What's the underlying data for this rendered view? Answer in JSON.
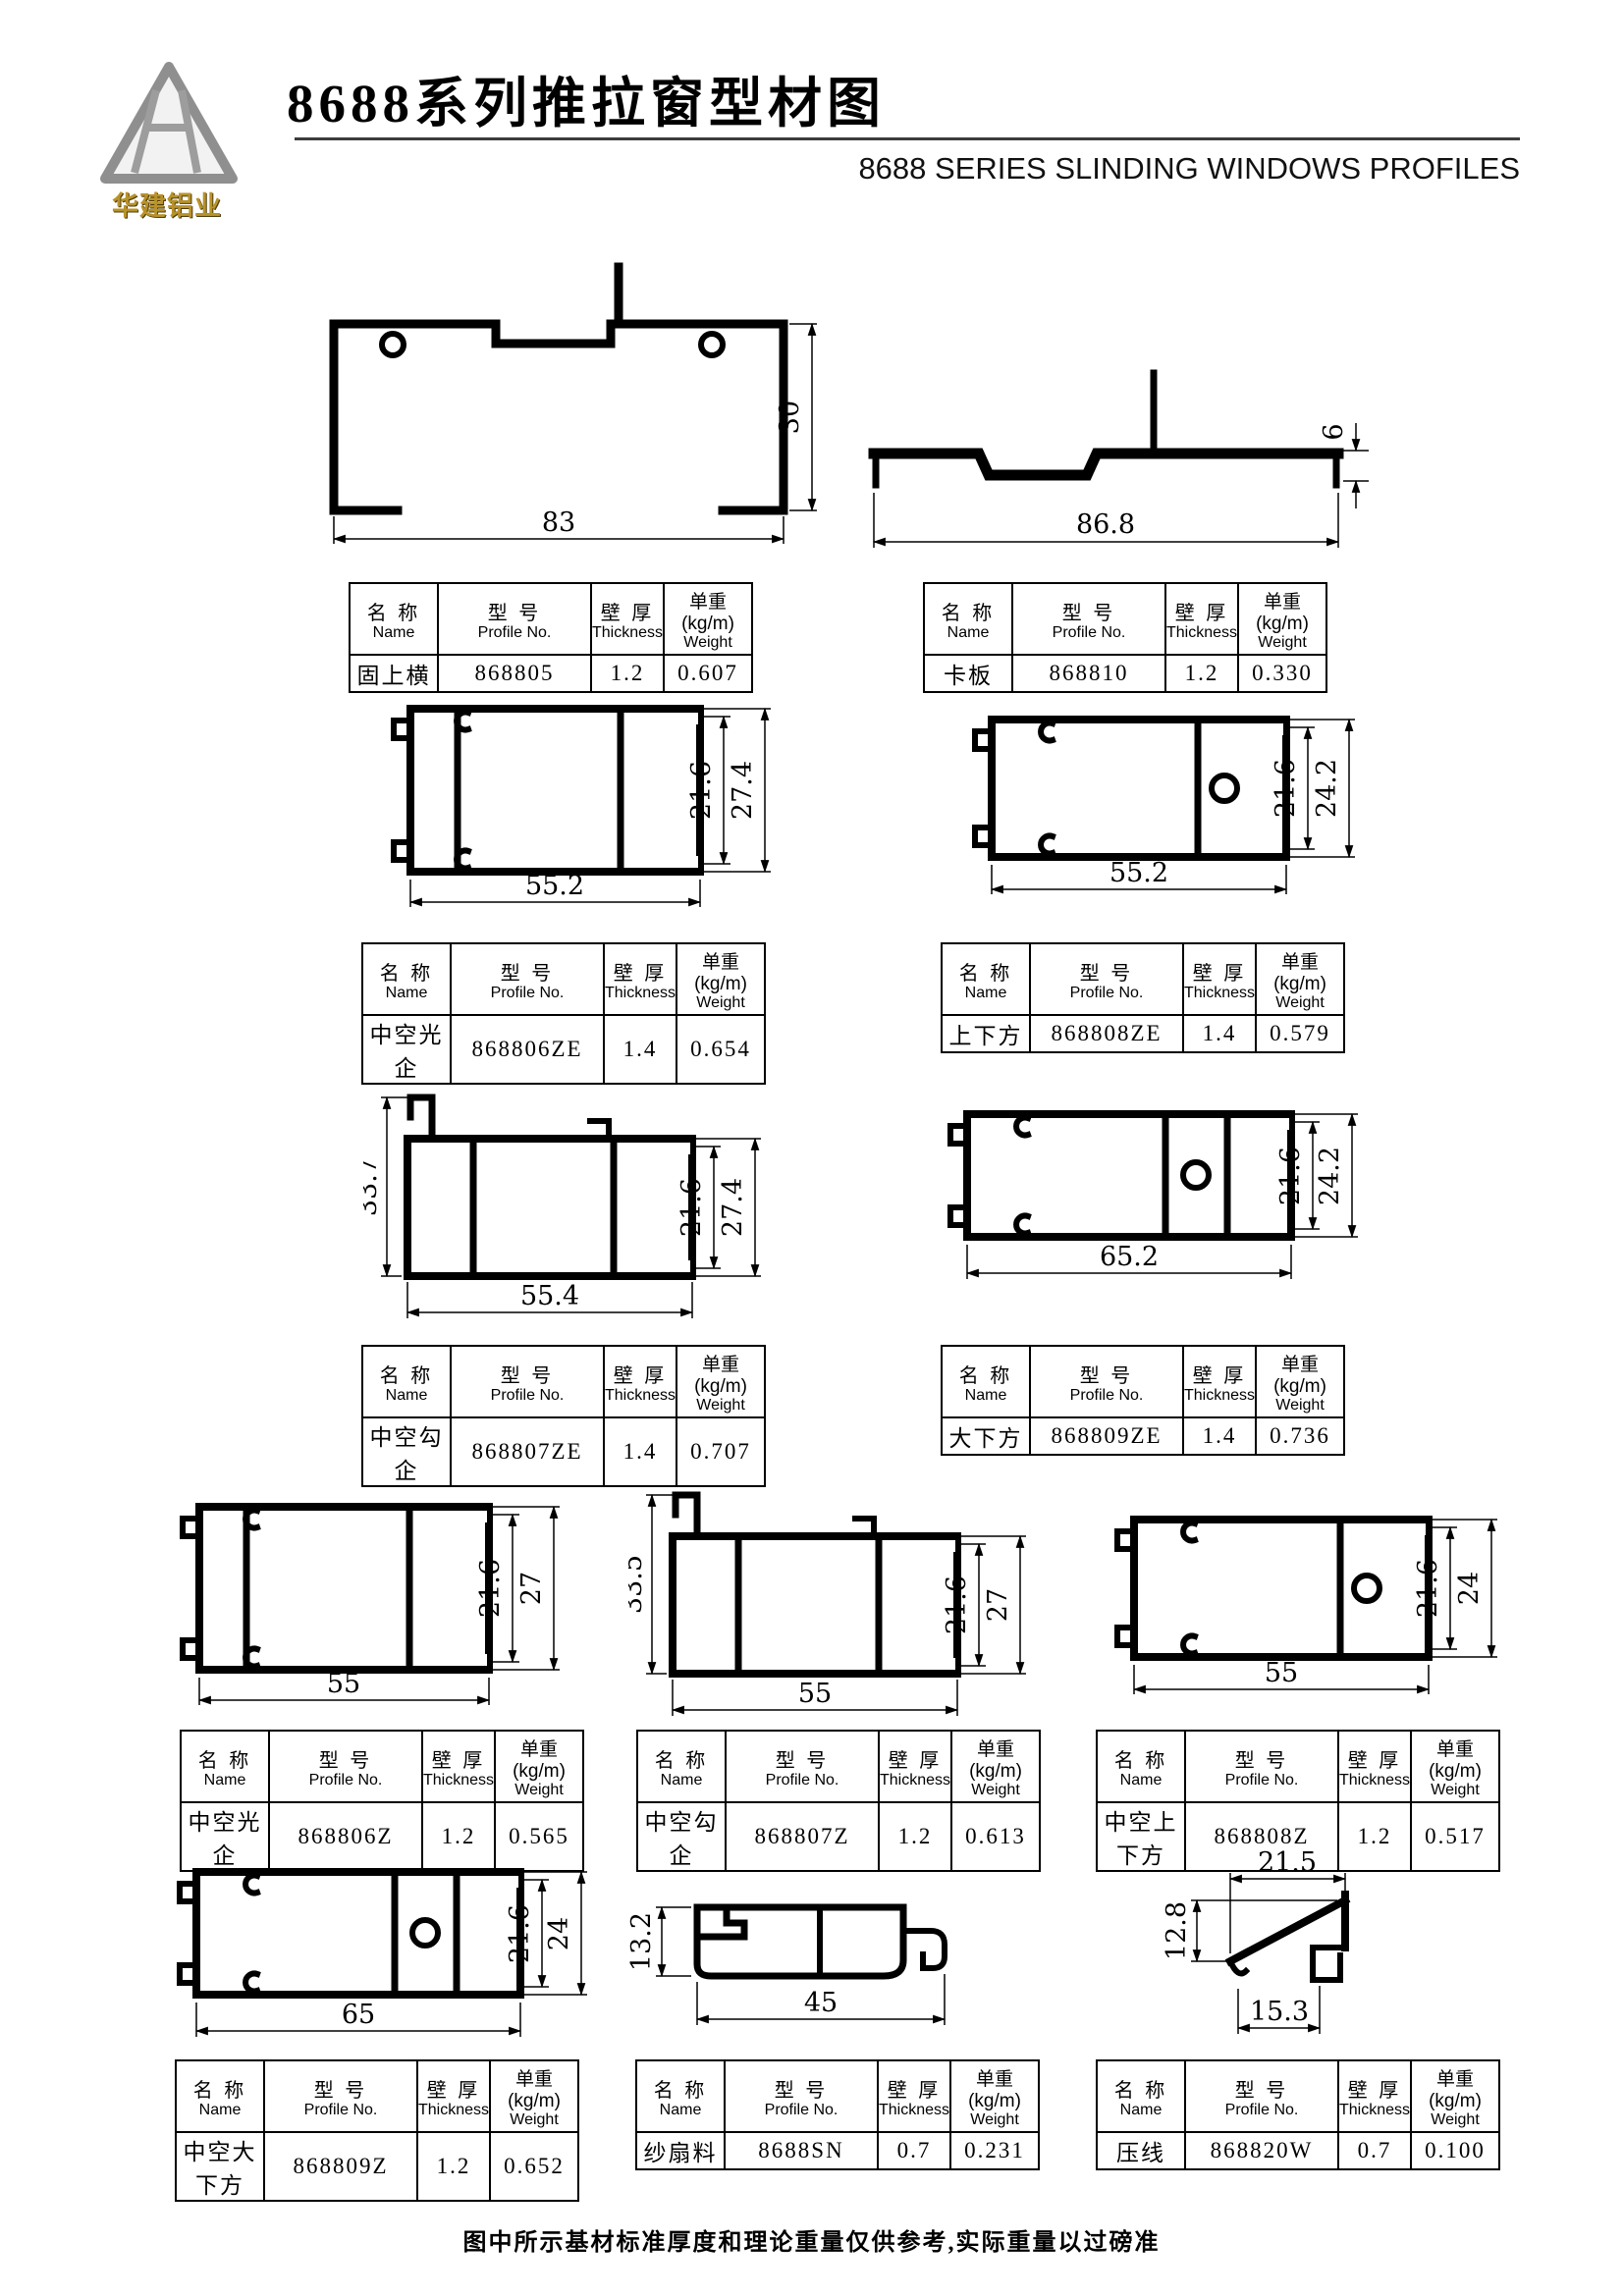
{
  "header": {
    "logo_text": "华建铝业",
    "title": "8688系列推拉窗型材图",
    "subtitle": "8688 SERIES SLINDING WINDOWS PROFILES"
  },
  "table_headers": {
    "name_cn": "名 称",
    "name_en": "Name",
    "profile_cn": "型 号",
    "profile_en": "Profile No.",
    "thickness_cn": "壁 厚",
    "thickness_en": "Thickness",
    "weight_cn": "单重(kg/m)",
    "weight_en": "Weight"
  },
  "profiles": [
    {
      "name": "固上横",
      "profile_no": "868805",
      "thickness": "1.2",
      "weight": "0.607",
      "dims": {
        "width": "83",
        "height": "30"
      }
    },
    {
      "name": "卡板",
      "profile_no": "868810",
      "thickness": "1.2",
      "weight": "0.330",
      "dims": {
        "width": "86.8",
        "height": "6"
      }
    },
    {
      "name": "中空光企",
      "profile_no": "868806ZE",
      "thickness": "1.4",
      "weight": "0.654",
      "dims": {
        "width": "55.2",
        "inner": "21.6",
        "outer": "27.4"
      }
    },
    {
      "name": "上下方",
      "profile_no": "868808ZE",
      "thickness": "1.4",
      "weight": "0.579",
      "dims": {
        "width": "55.2",
        "inner": "21.6",
        "outer": "24.2"
      }
    },
    {
      "name": "中空勾企",
      "profile_no": "868807ZE",
      "thickness": "1.4",
      "weight": "0.707",
      "dims": {
        "width": "55.4",
        "inner": "21.6",
        "outer": "27.4",
        "left": "33.7"
      }
    },
    {
      "name": "大下方",
      "profile_no": "868809ZE",
      "thickness": "1.4",
      "weight": "0.736",
      "dims": {
        "width": "65.2",
        "inner": "21.6",
        "outer": "24.2"
      }
    },
    {
      "name": "中空光企",
      "profile_no": "868806Z",
      "thickness": "1.2",
      "weight": "0.565",
      "dims": {
        "width": "55",
        "inner": "21.6",
        "outer": "27"
      }
    },
    {
      "name": "中空勾企",
      "profile_no": "868807Z",
      "thickness": "1.2",
      "weight": "0.613",
      "dims": {
        "width": "55",
        "inner": "21.6",
        "outer": "27",
        "left": "33.5"
      }
    },
    {
      "name": "中空上下方",
      "profile_no": "868808Z",
      "thickness": "1.2",
      "weight": "0.517",
      "dims": {
        "width": "55",
        "inner": "21.6",
        "outer": "24"
      }
    },
    {
      "name": "中空大下方",
      "profile_no": "868809Z",
      "thickness": "1.2",
      "weight": "0.652",
      "dims": {
        "width": "65",
        "inner": "21.6",
        "outer": "24"
      }
    },
    {
      "name": "纱扇料",
      "profile_no": "8688SN",
      "thickness": "0.7",
      "weight": "0.231",
      "dims": {
        "width": "45",
        "left": "13.2"
      }
    },
    {
      "name": "压线",
      "profile_no": "868820W",
      "thickness": "0.7",
      "weight": "0.100",
      "dims": {
        "top": "21.5",
        "left": "12.8",
        "bottom": "15.3"
      }
    }
  ],
  "footer": {
    "note": "图中所示基材标准厚度和理论重量仅供参考,实际重量以过磅准"
  }
}
